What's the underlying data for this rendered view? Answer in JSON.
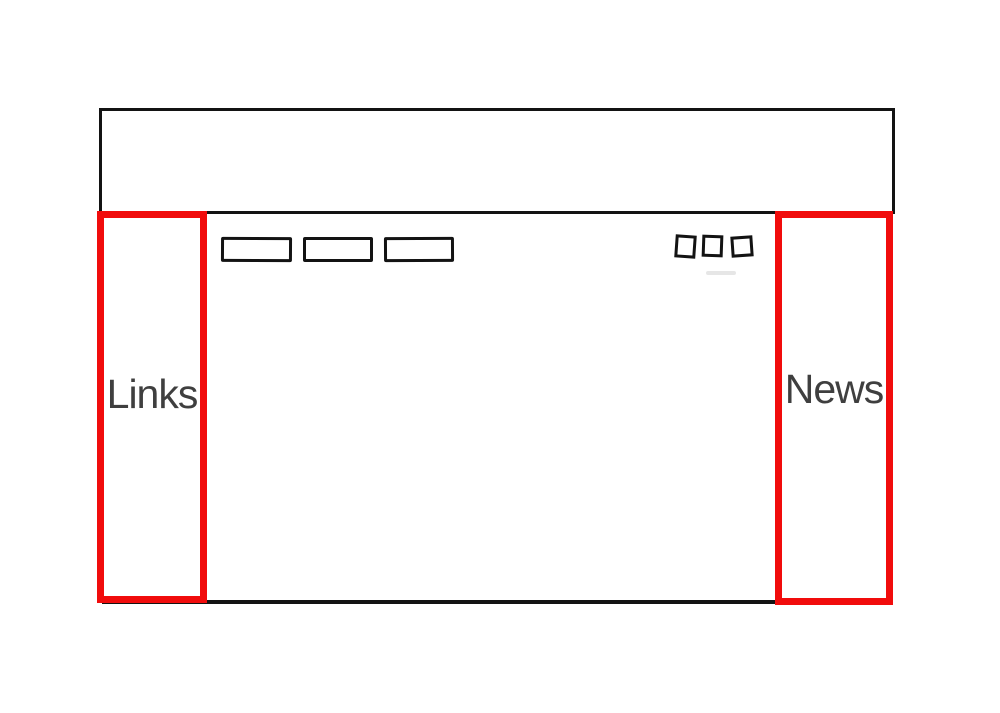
{
  "colors": {
    "background": "#ffffff",
    "ink": "#131313",
    "highlight_red": "#f10c0c",
    "label_text": "#3f3f3f"
  },
  "wireframe": {
    "header": {
      "description": "empty header banner"
    },
    "nav": {
      "button_placeholders": 3,
      "icon_placeholders": 3
    },
    "left_sidebar": {
      "label": "Links"
    },
    "right_sidebar": {
      "label": "News"
    }
  }
}
